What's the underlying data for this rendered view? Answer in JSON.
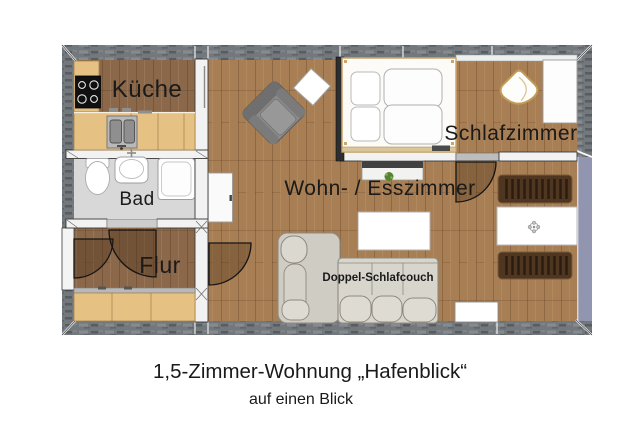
{
  "caption": {
    "title": "1,5-Zimmer-Wohnung „Hafenblick“",
    "subtitle": "auf einen Blick"
  },
  "rooms": {
    "kitchen": "Küche",
    "bath": "Bad",
    "hall": "Flur",
    "living": "Wohn- / Esszimmer",
    "bedroom": "Schlafzimmer"
  },
  "furniture": {
    "sofa": "Doppel-Schlafcouch"
  },
  "colors": {
    "outer_wall": "#73787d",
    "window_wall": "#9295af",
    "floor_living": "#a87e54",
    "floor_kitchen": "#8b684a",
    "floor_hall": "#8b684a",
    "floor_bath": "#d8d8d8",
    "cabinet_wood": "#e5c184",
    "bench_wood": "#4e3621",
    "couch_fabric": "#d8d5cd",
    "armchair": "#8a8a8a"
  }
}
